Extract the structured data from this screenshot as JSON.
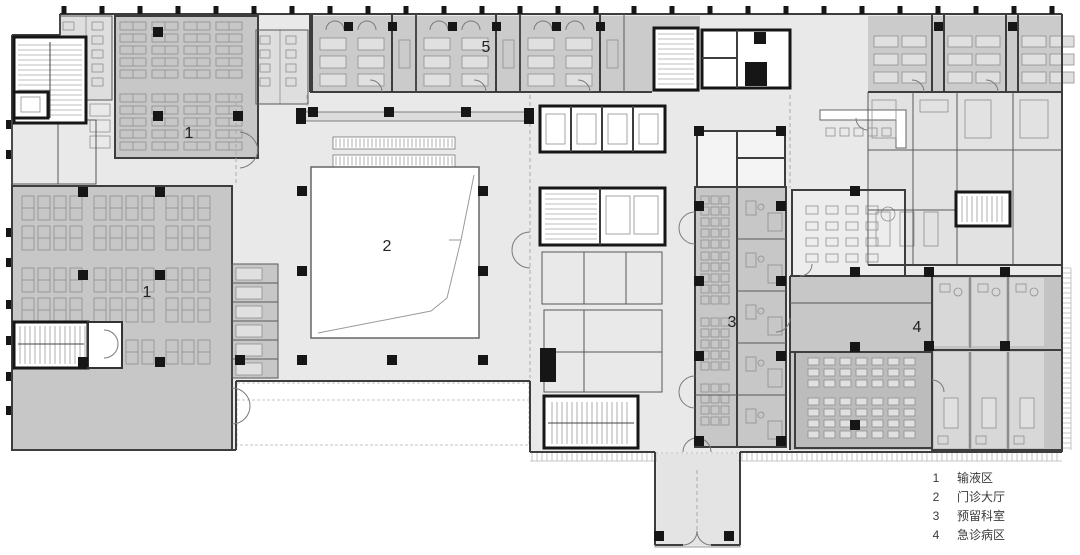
{
  "plan": {
    "area_labels": [
      {
        "id": "infusion-area-upper",
        "text": "1"
      },
      {
        "id": "infusion-area-lower",
        "text": "1"
      },
      {
        "id": "outpatient-hall",
        "text": "2"
      },
      {
        "id": "reserved-departments",
        "text": "3"
      },
      {
        "id": "emergency-ward",
        "text": "4"
      },
      {
        "id": "ward-strip",
        "text": "5"
      }
    ]
  },
  "legend": {
    "items": [
      {
        "num": "1",
        "label": "输液区"
      },
      {
        "num": "2",
        "label": "门诊大厅"
      },
      {
        "num": "3",
        "label": "预留科室"
      },
      {
        "num": "4",
        "label": "急诊病区"
      }
    ]
  },
  "colors": {
    "canvas": "#ffffff",
    "floor": "#e9e9e9",
    "room": "#c7c7c7",
    "room_dark": "#bcbcbc",
    "room_light": "#d8d8d8",
    "ward": "#cbcbcb",
    "wall": "#3d3d3d",
    "core": "#161616",
    "atrium": "#ffffff",
    "label": "#222222",
    "legend_text": "#3a3a3a"
  }
}
